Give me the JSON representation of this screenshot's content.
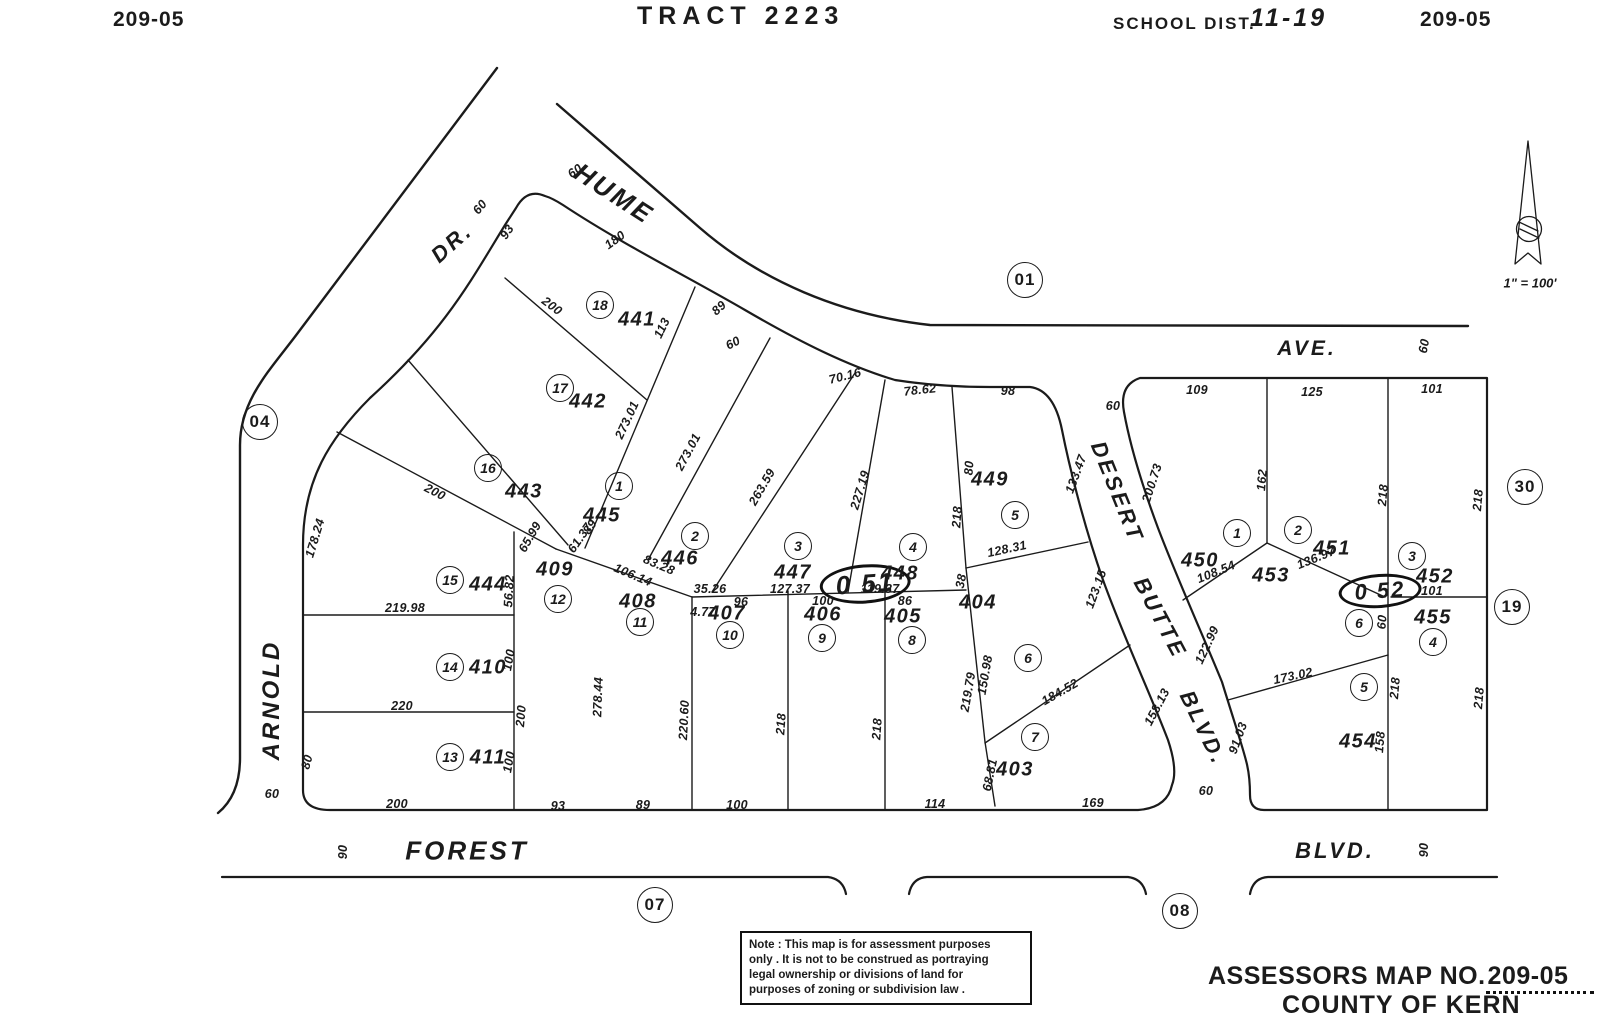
{
  "page": {
    "background": "#ffffff",
    "ink": "#1b1b1b"
  },
  "header": {
    "map_no_left": "209-05",
    "tract": "TRACT 2223",
    "school_dist_label": "SCHOOL DIST.",
    "school_dist_value": "11-19",
    "map_no_right": "209-05"
  },
  "north_arrow": {
    "scale_label": "1\" = 100'"
  },
  "note_box": {
    "lines": [
      "Note : This map is for assessment purposes",
      "only . It is not to be construed as portraying",
      "legal ownership or divisions of land for",
      "purposes of zoning or subdivision law ."
    ]
  },
  "footer": {
    "assessors_label": "ASSESSORS MAP NO.",
    "assessors_no": "209-05",
    "county": "COUNTY OF KERN"
  },
  "map": {
    "streets": [
      "HUME AVE.",
      "ARNOLD DR.",
      "DESERT BUTTE BLVD.",
      "FOREST BLVD."
    ],
    "labels": [
      {
        "t": "HUME",
        "x": 614,
        "y": 194,
        "r": 33,
        "s": 26,
        "k": "road"
      },
      {
        "t": "DR.",
        "x": 452,
        "y": 243,
        "r": -42,
        "s": 22,
        "k": "road"
      },
      {
        "t": "AVE.",
        "x": 1307,
        "y": 349,
        "s": 21,
        "k": "road"
      },
      {
        "t": "ARNOLD",
        "x": 272,
        "y": 700,
        "r": -90,
        "s": 24,
        "k": "road"
      },
      {
        "t": "DESERT",
        "x": 1117,
        "y": 492,
        "r": 68,
        "s": 22,
        "k": "road"
      },
      {
        "t": "BUTTE",
        "x": 1160,
        "y": 618,
        "r": 62,
        "s": 22,
        "k": "road"
      },
      {
        "t": "BLVD.",
        "x": 1203,
        "y": 728,
        "r": 64,
        "s": 22,
        "k": "road"
      },
      {
        "t": "FOREST",
        "x": 467,
        "y": 851,
        "s": 26,
        "k": "road"
      },
      {
        "t": "BLVD.",
        "x": 1335,
        "y": 851,
        "s": 22,
        "k": "road"
      },
      {
        "t": "60",
        "x": 480,
        "y": 207,
        "r": -50
      },
      {
        "t": "60",
        "x": 575,
        "y": 171,
        "r": -35
      },
      {
        "t": "60",
        "x": 272,
        "y": 794
      },
      {
        "t": "90",
        "x": 343,
        "y": 852,
        "r": -90
      },
      {
        "t": "90",
        "x": 1424,
        "y": 850,
        "r": -90
      },
      {
        "t": "60",
        "x": 1113,
        "y": 406
      },
      {
        "t": "60",
        "x": 1206,
        "y": 791
      },
      {
        "t": "60",
        "x": 1424,
        "y": 346,
        "r": -80
      },
      {
        "t": "01",
        "x": 1025,
        "y": 280,
        "k": "ref"
      },
      {
        "t": "04",
        "x": 260,
        "y": 422,
        "k": "ref"
      },
      {
        "t": "07",
        "x": 655,
        "y": 905,
        "k": "ref"
      },
      {
        "t": "08",
        "x": 1180,
        "y": 911,
        "k": "ref"
      },
      {
        "t": "30",
        "x": 1525,
        "y": 487,
        "k": "ref"
      },
      {
        "t": "19",
        "x": 1512,
        "y": 607,
        "k": "ref"
      },
      {
        "t": "0 51",
        "x": 865,
        "y": 584,
        "r": -4,
        "s": 26,
        "k": "oval"
      },
      {
        "t": "0 52",
        "x": 1380,
        "y": 591,
        "r": -4,
        "s": 22,
        "k": "oval"
      },
      {
        "t": "18",
        "x": 600,
        "y": 305,
        "k": "lot"
      },
      {
        "t": "17",
        "x": 560,
        "y": 388,
        "k": "lot"
      },
      {
        "t": "16",
        "x": 488,
        "y": 468,
        "k": "lot"
      },
      {
        "t": "15",
        "x": 450,
        "y": 580,
        "k": "lot"
      },
      {
        "t": "14",
        "x": 450,
        "y": 667,
        "k": "lot"
      },
      {
        "t": "13",
        "x": 450,
        "y": 757,
        "k": "lot"
      },
      {
        "t": "12",
        "x": 558,
        "y": 599,
        "k": "lot"
      },
      {
        "t": "11",
        "x": 640,
        "y": 622,
        "k": "lot"
      },
      {
        "t": "1",
        "x": 619,
        "y": 486,
        "k": "lot"
      },
      {
        "t": "2",
        "x": 695,
        "y": 536,
        "k": "lot"
      },
      {
        "t": "3",
        "x": 798,
        "y": 546,
        "k": "lot"
      },
      {
        "t": "4",
        "x": 913,
        "y": 547,
        "k": "lot"
      },
      {
        "t": "5",
        "x": 1015,
        "y": 515,
        "k": "lot"
      },
      {
        "t": "10",
        "x": 730,
        "y": 635,
        "k": "lot"
      },
      {
        "t": "9",
        "x": 822,
        "y": 638,
        "k": "lot"
      },
      {
        "t": "8",
        "x": 912,
        "y": 640,
        "k": "lot"
      },
      {
        "t": "6",
        "x": 1028,
        "y": 658,
        "k": "lot"
      },
      {
        "t": "7",
        "x": 1035,
        "y": 737,
        "k": "lot"
      },
      {
        "t": "1",
        "x": 1237,
        "y": 533,
        "k": "lot"
      },
      {
        "t": "2",
        "x": 1298,
        "y": 530,
        "k": "lot"
      },
      {
        "t": "3",
        "x": 1412,
        "y": 556,
        "k": "lot"
      },
      {
        "t": "6",
        "x": 1359,
        "y": 623,
        "k": "lot"
      },
      {
        "t": "4",
        "x": 1433,
        "y": 642,
        "k": "lot"
      },
      {
        "t": "5",
        "x": 1364,
        "y": 687,
        "k": "lot"
      },
      {
        "t": "441",
        "x": 637,
        "y": 320,
        "k": "parcel"
      },
      {
        "t": "442",
        "x": 588,
        "y": 402,
        "k": "parcel"
      },
      {
        "t": "443",
        "x": 524,
        "y": 492,
        "k": "parcel"
      },
      {
        "t": "444",
        "x": 488,
        "y": 585,
        "k": "parcel"
      },
      {
        "t": "445",
        "x": 602,
        "y": 516,
        "k": "parcel"
      },
      {
        "t": "446",
        "x": 680,
        "y": 559,
        "k": "parcel"
      },
      {
        "t": "447",
        "x": 793,
        "y": 573,
        "k": "parcel"
      },
      {
        "t": "448",
        "x": 900,
        "y": 574,
        "k": "parcel"
      },
      {
        "t": "449",
        "x": 990,
        "y": 480,
        "k": "parcel"
      },
      {
        "t": "450",
        "x": 1200,
        "y": 561,
        "k": "parcel"
      },
      {
        "t": "451",
        "x": 1332,
        "y": 549,
        "k": "parcel"
      },
      {
        "t": "452",
        "x": 1435,
        "y": 577,
        "k": "parcel"
      },
      {
        "t": "453",
        "x": 1271,
        "y": 576,
        "k": "parcel"
      },
      {
        "t": "454",
        "x": 1358,
        "y": 742,
        "k": "parcel"
      },
      {
        "t": "455",
        "x": 1433,
        "y": 618,
        "k": "parcel"
      },
      {
        "t": "403",
        "x": 1015,
        "y": 770,
        "k": "parcel"
      },
      {
        "t": "404",
        "x": 978,
        "y": 603,
        "k": "parcel"
      },
      {
        "t": "405",
        "x": 903,
        "y": 617,
        "k": "parcel"
      },
      {
        "t": "406",
        "x": 823,
        "y": 615,
        "k": "parcel"
      },
      {
        "t": "407",
        "x": 727,
        "y": 614,
        "k": "parcel"
      },
      {
        "t": "408",
        "x": 638,
        "y": 602,
        "k": "parcel"
      },
      {
        "t": "409",
        "x": 555,
        "y": 570,
        "k": "parcel"
      },
      {
        "t": "410",
        "x": 488,
        "y": 668,
        "k": "parcel"
      },
      {
        "t": "411",
        "x": 488,
        "y": 758,
        "k": "parcel"
      },
      {
        "t": "93",
        "x": 507,
        "y": 232,
        "r": -55
      },
      {
        "t": "180",
        "x": 615,
        "y": 240,
        "r": -36
      },
      {
        "t": "200",
        "x": 552,
        "y": 306,
        "r": 37
      },
      {
        "t": "113",
        "x": 662,
        "y": 328,
        "r": -64
      },
      {
        "t": "89",
        "x": 719,
        "y": 308,
        "r": -42
      },
      {
        "t": "273.01",
        "x": 627,
        "y": 420,
        "r": -65
      },
      {
        "t": "273.01",
        "x": 688,
        "y": 452,
        "r": -62
      },
      {
        "t": "263.59",
        "x": 762,
        "y": 487,
        "r": -60
      },
      {
        "t": "227.19",
        "x": 860,
        "y": 490,
        "r": -73
      },
      {
        "t": "60",
        "x": 733,
        "y": 343,
        "r": -27
      },
      {
        "t": "70.16",
        "x": 845,
        "y": 376,
        "r": -14
      },
      {
        "t": "78.62",
        "x": 920,
        "y": 390,
        "r": -6
      },
      {
        "t": "98",
        "x": 1008,
        "y": 391
      },
      {
        "t": "218",
        "x": 957,
        "y": 517,
        "r": -86
      },
      {
        "t": "80",
        "x": 969,
        "y": 468,
        "r": -86
      },
      {
        "t": "128.31",
        "x": 1007,
        "y": 549,
        "r": -12
      },
      {
        "t": "133.47",
        "x": 1076,
        "y": 474,
        "r": -70
      },
      {
        "t": "123.15",
        "x": 1096,
        "y": 589,
        "r": -70
      },
      {
        "t": "200.73",
        "x": 1152,
        "y": 483,
        "r": -72
      },
      {
        "t": "158.13",
        "x": 1157,
        "y": 707,
        "r": -62
      },
      {
        "t": "122.99",
        "x": 1207,
        "y": 645,
        "r": -65
      },
      {
        "t": "91.03",
        "x": 1238,
        "y": 738,
        "r": -70
      },
      {
        "t": "173.02",
        "x": 1293,
        "y": 676,
        "r": -12
      },
      {
        "t": "108.54",
        "x": 1216,
        "y": 572,
        "r": -22
      },
      {
        "t": "136.97",
        "x": 1316,
        "y": 558,
        "r": -22
      },
      {
        "t": "109",
        "x": 1197,
        "y": 390
      },
      {
        "t": "125",
        "x": 1312,
        "y": 392
      },
      {
        "t": "101",
        "x": 1432,
        "y": 389
      },
      {
        "t": "162",
        "x": 1262,
        "y": 480,
        "r": -85
      },
      {
        "t": "218",
        "x": 1383,
        "y": 495,
        "r": -85
      },
      {
        "t": "218",
        "x": 1478,
        "y": 500,
        "r": -85
      },
      {
        "t": "101",
        "x": 1432,
        "y": 591
      },
      {
        "t": "60",
        "x": 1382,
        "y": 622,
        "r": -85
      },
      {
        "t": "218",
        "x": 1395,
        "y": 688,
        "r": -85
      },
      {
        "t": "218",
        "x": 1479,
        "y": 698,
        "r": -85
      },
      {
        "t": "158",
        "x": 1380,
        "y": 742,
        "r": -85
      },
      {
        "t": "178.24",
        "x": 315,
        "y": 538,
        "r": -73
      },
      {
        "t": "200",
        "x": 435,
        "y": 492,
        "r": 27
      },
      {
        "t": "65.99",
        "x": 530,
        "y": 537,
        "r": -60
      },
      {
        "t": "61.37",
        "x": 580,
        "y": 538,
        "r": -55
      },
      {
        "t": "89",
        "x": 590,
        "y": 527,
        "r": -55
      },
      {
        "t": "106.14",
        "x": 633,
        "y": 575,
        "r": 23
      },
      {
        "t": "83.28",
        "x": 659,
        "y": 565,
        "r": 23
      },
      {
        "t": "56.82",
        "x": 509,
        "y": 591,
        "r": -87
      },
      {
        "t": "219.98",
        "x": 405,
        "y": 608
      },
      {
        "t": "220",
        "x": 402,
        "y": 706
      },
      {
        "t": "100",
        "x": 509,
        "y": 660,
        "r": -80
      },
      {
        "t": "200",
        "x": 521,
        "y": 716,
        "r": -85
      },
      {
        "t": "100",
        "x": 509,
        "y": 762,
        "r": -80
      },
      {
        "t": "80",
        "x": 307,
        "y": 762,
        "r": -75
      },
      {
        "t": "35.26",
        "x": 710,
        "y": 589
      },
      {
        "t": "96",
        "x": 741,
        "y": 602
      },
      {
        "t": "4.77",
        "x": 703,
        "y": 612
      },
      {
        "t": "127.37",
        "x": 790,
        "y": 589
      },
      {
        "t": "100",
        "x": 823,
        "y": 601
      },
      {
        "t": "119.37",
        "x": 880,
        "y": 589
      },
      {
        "t": "86",
        "x": 905,
        "y": 601
      },
      {
        "t": "150.98",
        "x": 985,
        "y": 675,
        "r": -80
      },
      {
        "t": "219.79",
        "x": 968,
        "y": 692,
        "r": -80
      },
      {
        "t": "184.52",
        "x": 1060,
        "y": 692,
        "r": -30
      },
      {
        "t": "68.81",
        "x": 990,
        "y": 775,
        "r": -78
      },
      {
        "t": "38",
        "x": 961,
        "y": 581,
        "r": -80
      },
      {
        "t": "220.60",
        "x": 684,
        "y": 720,
        "r": -87
      },
      {
        "t": "218",
        "x": 781,
        "y": 724,
        "r": -86
      },
      {
        "t": "218",
        "x": 877,
        "y": 729,
        "r": -86
      },
      {
        "t": "278.44",
        "x": 598,
        "y": 697,
        "r": -88
      },
      {
        "t": "200",
        "x": 397,
        "y": 804
      },
      {
        "t": "93",
        "x": 558,
        "y": 806
      },
      {
        "t": "89",
        "x": 643,
        "y": 805
      },
      {
        "t": "100",
        "x": 737,
        "y": 805
      },
      {
        "t": "114",
        "x": 935,
        "y": 804
      },
      {
        "t": "169",
        "x": 1093,
        "y": 803
      },
      {
        "t": "1\" = 100'",
        "x": 1530,
        "y": 283,
        "k": "scale"
      }
    ]
  }
}
